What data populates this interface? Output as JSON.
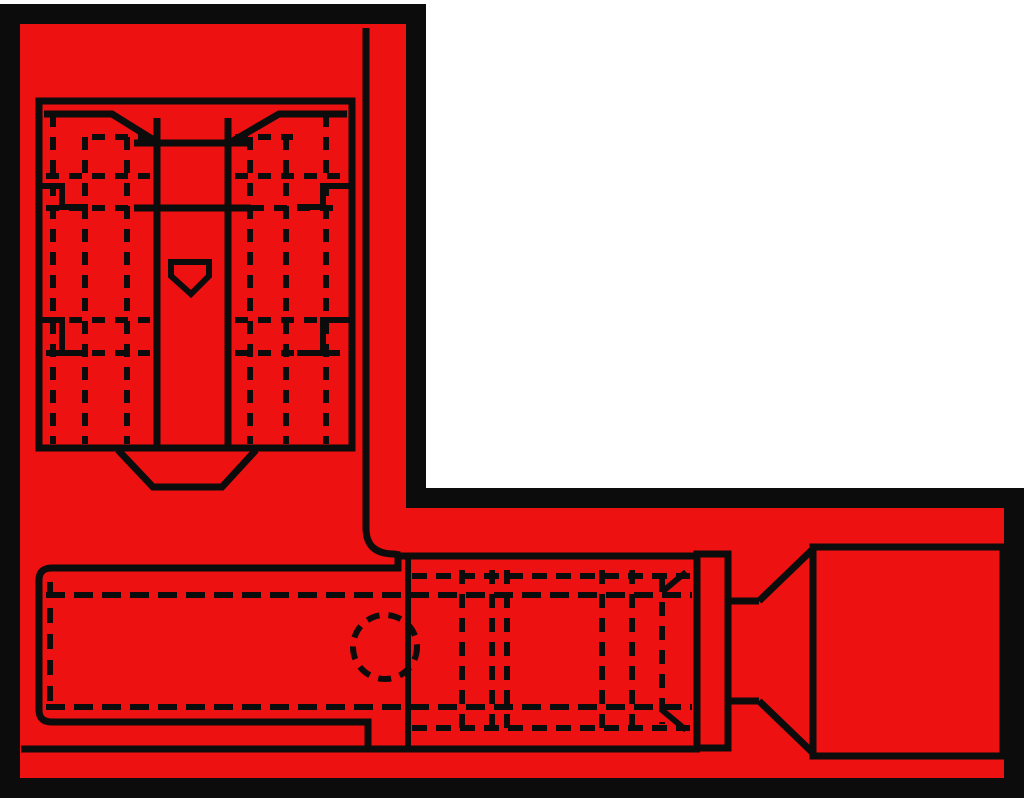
{
  "meta": {
    "component": "flag-quick-disconnect-terminal",
    "view_top": "receptacle-top-view",
    "view_side": "terminal-side-view"
  },
  "canvas": {
    "width": 1024,
    "height": 804,
    "background": "#ffffff"
  },
  "colors": {
    "body_fill": "#ee1111",
    "line": "#0c0c0c",
    "margin": "#ffffff"
  },
  "drawing": {
    "groups": [
      {
        "name": "outer-shell",
        "shapes": [
          {
            "tag": "polygon",
            "name": "l-shaped-body-outline",
            "attrs": {
              "points": "10,14 416,14 416,498 1014,498 1014,788 10,788",
              "fill": "#ee1111",
              "stroke-width": "20",
              "stroke-linejoin": "miter"
            }
          }
        ]
      },
      {
        "name": "top-view-receptacle",
        "shapes": [
          {
            "tag": "rect",
            "name": "receptacle-box",
            "attrs": {
              "x": "39",
              "y": "101",
              "width": "313",
              "height": "347",
              "stroke-width": "7"
            }
          },
          {
            "tag": "polyline",
            "name": "funnel-lip-left",
            "attrs": {
              "points": "44,114 112,114 157,142",
              "stroke-width": "7"
            }
          },
          {
            "tag": "polyline",
            "name": "funnel-lip-right",
            "attrs": {
              "points": "347,114 279,114 231,142",
              "stroke-width": "7"
            }
          },
          {
            "tag": "line",
            "name": "channel-wall-left",
            "attrs": {
              "x1": "157",
              "y1": "118",
              "x2": "157",
              "y2": "448",
              "stroke-width": "7"
            }
          },
          {
            "tag": "line",
            "name": "channel-wall-right",
            "attrs": {
              "x1": "228",
              "y1": "118",
              "x2": "228",
              "y2": "448",
              "stroke-width": "7"
            }
          },
          {
            "tag": "line",
            "name": "channel-cross-line-1",
            "attrs": {
              "x1": "134",
              "y1": "143",
              "x2": "251",
              "y2": "143",
              "stroke-width": "7"
            }
          },
          {
            "tag": "line",
            "name": "channel-cross-line-2",
            "attrs": {
              "x1": "134",
              "y1": "208",
              "x2": "251",
              "y2": "208",
              "stroke-width": "7"
            }
          },
          {
            "tag": "line",
            "name": "wing-dash-vertical-l1",
            "attrs": {
              "x1": "53",
              "y1": "114",
              "x2": "53",
              "y2": "444",
              "stroke-width": "6",
              "stroke-dasharray": "13 10"
            }
          },
          {
            "tag": "line",
            "name": "wing-dash-vertical-l2",
            "attrs": {
              "x1": "85",
              "y1": "137",
              "x2": "85",
              "y2": "444",
              "stroke-width": "6",
              "stroke-dasharray": "13 10"
            }
          },
          {
            "tag": "line",
            "name": "wing-dash-vertical-l3",
            "attrs": {
              "x1": "127",
              "y1": "137",
              "x2": "127",
              "y2": "444",
              "stroke-width": "6",
              "stroke-dasharray": "13 10"
            }
          },
          {
            "tag": "line",
            "name": "wing-dash-vertical-r1",
            "attrs": {
              "x1": "250",
              "y1": "137",
              "x2": "250",
              "y2": "444",
              "stroke-width": "6",
              "stroke-dasharray": "13 10"
            }
          },
          {
            "tag": "line",
            "name": "wing-dash-vertical-r2",
            "attrs": {
              "x1": "286",
              "y1": "137",
              "x2": "286",
              "y2": "444",
              "stroke-width": "6",
              "stroke-dasharray": "13 10"
            }
          },
          {
            "tag": "line",
            "name": "wing-dash-vertical-r3",
            "attrs": {
              "x1": "326",
              "y1": "114",
              "x2": "326",
              "y2": "444",
              "stroke-width": "6",
              "stroke-dasharray": "13 10"
            }
          },
          {
            "tag": "line",
            "name": "wing-dash-top-l",
            "attrs": {
              "x1": "92",
              "y1": "137",
              "x2": "150",
              "y2": "137",
              "stroke-width": "6",
              "stroke-dasharray": "13 10"
            }
          },
          {
            "tag": "line",
            "name": "wing-dash-top-r",
            "attrs": {
              "x1": "235",
              "y1": "137",
              "x2": "293",
              "y2": "137",
              "stroke-width": "6",
              "stroke-dasharray": "13 10"
            }
          },
          {
            "tag": "line",
            "name": "wing-dash-row1-l",
            "attrs": {
              "x1": "46",
              "y1": "176",
              "x2": "150",
              "y2": "176",
              "stroke-width": "6",
              "stroke-dasharray": "13 10"
            }
          },
          {
            "tag": "line",
            "name": "wing-dash-row1-r",
            "attrs": {
              "x1": "235",
              "y1": "176",
              "x2": "340",
              "y2": "176",
              "stroke-width": "6",
              "stroke-dasharray": "13 10"
            }
          },
          {
            "tag": "line",
            "name": "wing-dash-row2-l",
            "attrs": {
              "x1": "46",
              "y1": "208",
              "x2": "134",
              "y2": "208",
              "stroke-width": "6",
              "stroke-dasharray": "13 10"
            }
          },
          {
            "tag": "line",
            "name": "wing-dash-row2-r",
            "attrs": {
              "x1": "251",
              "y1": "208",
              "x2": "340",
              "y2": "208",
              "stroke-width": "6",
              "stroke-dasharray": "13 10"
            }
          },
          {
            "tag": "line",
            "name": "wing-dash-row3-l",
            "attrs": {
              "x1": "46",
              "y1": "320",
              "x2": "150",
              "y2": "320",
              "stroke-width": "6",
              "stroke-dasharray": "13 10"
            }
          },
          {
            "tag": "line",
            "name": "wing-dash-row3-r",
            "attrs": {
              "x1": "235",
              "y1": "320",
              "x2": "340",
              "y2": "320",
              "stroke-width": "6",
              "stroke-dasharray": "13 10"
            }
          },
          {
            "tag": "line",
            "name": "wing-dash-row4-l",
            "attrs": {
              "x1": "46",
              "y1": "353",
              "x2": "150",
              "y2": "353",
              "stroke-width": "6",
              "stroke-dasharray": "13 10"
            }
          },
          {
            "tag": "line",
            "name": "wing-dash-row4-r",
            "attrs": {
              "x1": "235",
              "y1": "353",
              "x2": "340",
              "y2": "353",
              "stroke-width": "6",
              "stroke-dasharray": "13 10"
            }
          },
          {
            "tag": "polyline",
            "name": "wing-fold-step-upper-left",
            "attrs": {
              "points": "41,186 62,186 62,207 88,207",
              "stroke-width": "6"
            }
          },
          {
            "tag": "polyline",
            "name": "wing-fold-step-lower-left",
            "attrs": {
              "points": "41,320 62,320 62,353 88,353",
              "stroke-width": "6"
            }
          },
          {
            "tag": "polyline",
            "name": "wing-fold-step-upper-right",
            "attrs": {
              "points": "350,186 323,186 323,207 297,207",
              "stroke-width": "6"
            }
          },
          {
            "tag": "polyline",
            "name": "wing-fold-step-lower-right",
            "attrs": {
              "points": "350,320 323,320 323,353 297,353",
              "stroke-width": "6"
            }
          },
          {
            "tag": "polygon",
            "name": "detent-dimple",
            "attrs": {
              "points": "171,262 209,262 209,276 191,294 171,276",
              "stroke-width": "6"
            }
          },
          {
            "tag": "polyline",
            "name": "neck-trapezoid",
            "attrs": {
              "points": "118,450 153,487 222,487 256,450",
              "stroke-width": "7"
            }
          },
          {
            "tag": "path",
            "name": "flag-fold-edge",
            "attrs": {
              "d": "M 366,28 L 366,528 Q 366,554 394,554 L 400,555",
              "stroke-width": "7"
            }
          }
        ]
      },
      {
        "name": "side-view-terminal",
        "shapes": [
          {
            "tag": "path",
            "name": "body-left-outline",
            "attrs": {
              "d": "M 368,749 L 368,722 L 52,722 Q 39,722 39,710 L 39,580 Q 39,568 52,568 L 398,568 L 398,556",
              "stroke-width": "7"
            }
          },
          {
            "tag": "line",
            "name": "crimp-top-edge",
            "attrs": {
              "x1": "395",
              "y1": "556",
              "x2": "700",
              "y2": "556",
              "stroke-width": "7"
            }
          },
          {
            "tag": "line",
            "name": "flag-bottom-edge",
            "attrs": {
              "x1": "21",
              "y1": "749",
              "x2": "700",
              "y2": "749",
              "stroke-width": "7"
            }
          },
          {
            "tag": "line",
            "name": "crimp-left-wall",
            "attrs": {
              "x1": "408",
              "y1": "558",
              "x2": "408",
              "y2": "746",
              "stroke-width": "6"
            }
          },
          {
            "tag": "line",
            "name": "body-dash-top",
            "attrs": {
              "x1": "46",
              "y1": "595",
              "x2": "692",
              "y2": "595",
              "stroke-width": "6",
              "stroke-dasharray": "19 9"
            }
          },
          {
            "tag": "line",
            "name": "body-dash-bottom",
            "attrs": {
              "x1": "46",
              "y1": "707",
              "x2": "692",
              "y2": "707",
              "stroke-width": "6",
              "stroke-dasharray": "19 9"
            }
          },
          {
            "tag": "line",
            "name": "front-opening-dash",
            "attrs": {
              "x1": "50",
              "y1": "582",
              "x2": "50",
              "y2": "712",
              "stroke-width": "6",
              "stroke-dasharray": "15 11"
            }
          },
          {
            "tag": "circle",
            "name": "inspection-hole-dashed-circle",
            "attrs": {
              "cx": "385",
              "cy": "647",
              "r": "32",
              "stroke-width": "6",
              "stroke-dasharray": "13 9"
            }
          },
          {
            "tag": "line",
            "name": "crimp-dash-v1",
            "attrs": {
              "x1": "462",
              "y1": "570",
              "x2": "462",
              "y2": "731",
              "stroke-width": "6",
              "stroke-dasharray": "14 10"
            }
          },
          {
            "tag": "line",
            "name": "crimp-dash-v2",
            "attrs": {
              "x1": "492",
              "y1": "570",
              "x2": "492",
              "y2": "731",
              "stroke-width": "6",
              "stroke-dasharray": "14 10"
            }
          },
          {
            "tag": "line",
            "name": "crimp-dash-v3",
            "attrs": {
              "x1": "507",
              "y1": "570",
              "x2": "507",
              "y2": "731",
              "stroke-width": "6",
              "stroke-dasharray": "14 10"
            }
          },
          {
            "tag": "line",
            "name": "crimp-dash-v4",
            "attrs": {
              "x1": "602",
              "y1": "570",
              "x2": "602",
              "y2": "731",
              "stroke-width": "6",
              "stroke-dasharray": "14 10"
            }
          },
          {
            "tag": "line",
            "name": "crimp-dash-v5",
            "attrs": {
              "x1": "632",
              "y1": "570",
              "x2": "632",
              "y2": "731",
              "stroke-width": "6",
              "stroke-dasharray": "14 10"
            }
          },
          {
            "tag": "line",
            "name": "crimp-dash-v6",
            "attrs": {
              "x1": "662",
              "y1": "578",
              "x2": "662",
              "y2": "724",
              "stroke-width": "6",
              "stroke-dasharray": "14 10"
            }
          },
          {
            "tag": "line",
            "name": "crimp-flare-top",
            "attrs": {
              "x1": "662",
              "y1": "592",
              "x2": "686",
              "y2": "572",
              "stroke-width": "6"
            }
          },
          {
            "tag": "line",
            "name": "crimp-flare-bottom",
            "attrs": {
              "x1": "662",
              "y1": "710",
              "x2": "686",
              "y2": "730",
              "stroke-width": "6"
            }
          },
          {
            "tag": "line",
            "name": "crimp-seam-dash-top",
            "attrs": {
              "x1": "412",
              "y1": "576",
              "x2": "690",
              "y2": "576",
              "stroke-width": "6",
              "stroke-dasharray": "15 9"
            }
          },
          {
            "tag": "line",
            "name": "crimp-seam-dash-bottom",
            "attrs": {
              "x1": "412",
              "y1": "728",
              "x2": "690",
              "y2": "728",
              "stroke-width": "6",
              "stroke-dasharray": "15 9"
            }
          },
          {
            "tag": "rect",
            "name": "insulation-stop-band",
            "attrs": {
              "x": "697",
              "y": "554",
              "width": "31",
              "height": "194",
              "stroke-width": "7"
            }
          },
          {
            "tag": "line",
            "name": "neck-top-line",
            "attrs": {
              "x1": "728",
              "y1": "601",
              "x2": "759",
              "y2": "601",
              "stroke-width": "7"
            }
          },
          {
            "tag": "line",
            "name": "neck-bottom-line",
            "attrs": {
              "x1": "728",
              "y1": "701",
              "x2": "759",
              "y2": "701",
              "stroke-width": "7"
            }
          },
          {
            "tag": "line",
            "name": "funnel-diagonal-top",
            "attrs": {
              "x1": "759",
              "y1": "601",
              "x2": "813",
              "y2": "549",
              "stroke-width": "7"
            }
          },
          {
            "tag": "line",
            "name": "funnel-diagonal-bottom",
            "attrs": {
              "x1": "759",
              "y1": "701",
              "x2": "813",
              "y2": "753",
              "stroke-width": "7"
            }
          },
          {
            "tag": "rect",
            "name": "wire-insulation-end",
            "attrs": {
              "x": "813",
              "y": "547",
              "width": "190",
              "height": "209",
              "stroke-width": "7"
            }
          }
        ]
      }
    ]
  }
}
